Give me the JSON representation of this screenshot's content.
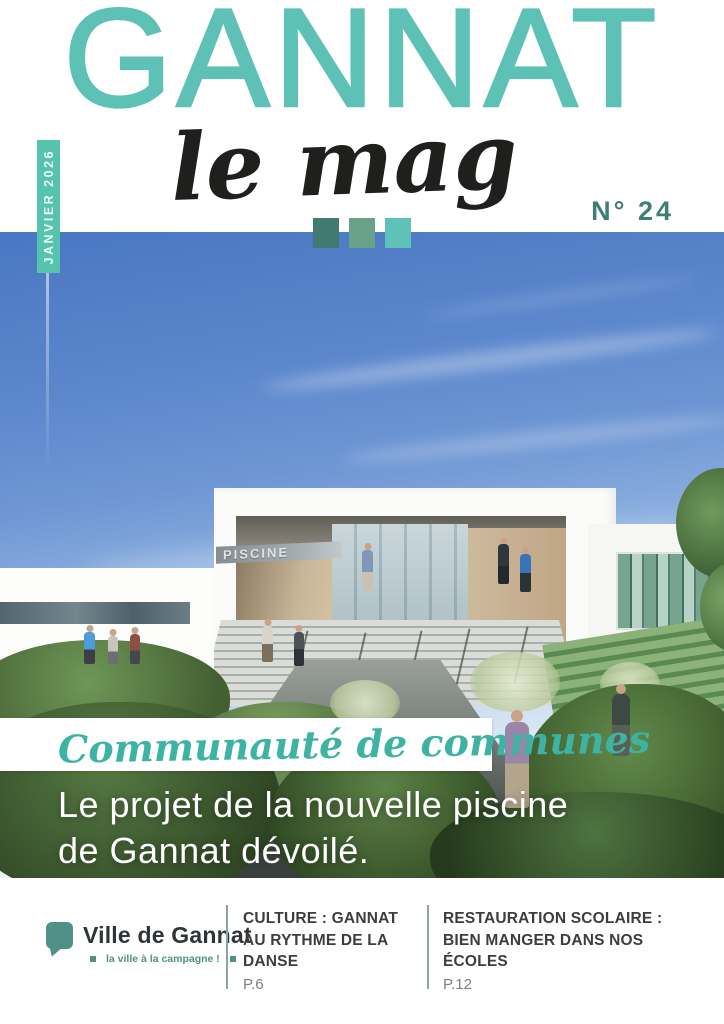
{
  "masthead": {
    "title": "GANNAT",
    "subtitle": "le mag",
    "issue": "N° 24",
    "date": "JANVIER 2026"
  },
  "cover": {
    "building_sign": "PISCINE",
    "kicker": "Communauté de communes",
    "headline_line1": "Le projet de la nouvelle piscine",
    "headline_line2": "de Gannat dévoilé."
  },
  "footer": {
    "logo": {
      "name": "Ville de Gannat",
      "tagline": "la ville à la campagne !"
    },
    "teasers": [
      {
        "title": "CULTURE : GANNAT AU RYTHME DE LA DANSE",
        "page": "P.6"
      },
      {
        "title": "RESTAURATION SCOLAIRE : BIEN MANGER DANS NOS ÉCOLES",
        "page": "P.12"
      }
    ]
  },
  "colors": {
    "teal_primary": "#5ec1b6",
    "teal_ribbon": "#56c3ad",
    "teal_dark": "#3f7e76",
    "square_dark": "#417a70",
    "square_mid": "#69a287",
    "square_light": "#5fc2b8",
    "logo_teal": "#4f9187",
    "ink": "#1f1f1d",
    "footer_ink": "#3d3d3d",
    "page_ref_gray": "#7e7e7e"
  }
}
